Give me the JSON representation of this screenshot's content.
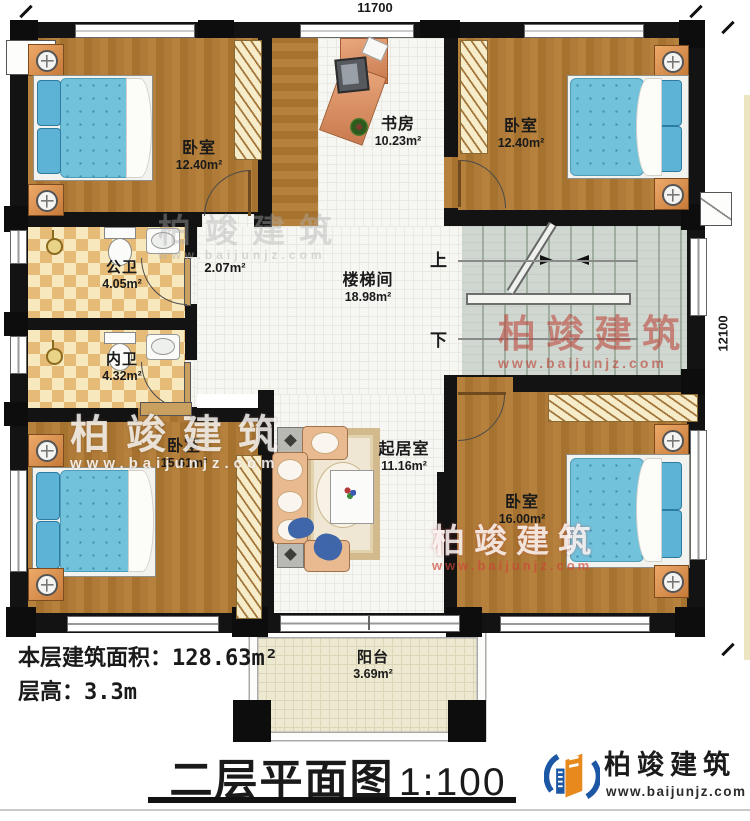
{
  "dimensions": {
    "top": "11700",
    "right": "12100"
  },
  "rooms": {
    "bedroom_tl": {
      "name": "卧室",
      "area": "12.40m²"
    },
    "study": {
      "name": "书房",
      "area": "10.23m²"
    },
    "bedroom_tr": {
      "name": "卧室",
      "area": "12.40m²"
    },
    "public_bath": {
      "name": "公卫",
      "area": "4.05m²"
    },
    "nook": {
      "area": "2.07m²"
    },
    "private_bath": {
      "name": "内卫",
      "area": "4.32m²"
    },
    "stair_hall": {
      "name": "楼梯间",
      "area": "18.98m²"
    },
    "bedroom_bl": {
      "name": "卧室",
      "area": "15.61m²"
    },
    "living": {
      "name": "起居室",
      "area": "11.16m²"
    },
    "bedroom_br": {
      "name": "卧室",
      "area": "16.00m²"
    },
    "balcony": {
      "name": "阳台",
      "area": "3.69m²"
    }
  },
  "stairs": {
    "up": "上",
    "down": "下"
  },
  "info": {
    "area_label": "本层建筑面积：",
    "area_value": "128.63m²",
    "height_label": "层高：",
    "height_value": "3.3m"
  },
  "footer": {
    "title": "二层平面图",
    "scale": "1:100"
  },
  "watermark": {
    "brand": "柏竣建筑",
    "url": "www.baijunjz.com"
  },
  "logo": {
    "brand": "柏竣建筑",
    "url": "www.baijunjz.com"
  },
  "colors": {
    "wall": "#131313",
    "wood": "#ad7a36",
    "tile": "#f6f6f3",
    "checker": "#e6bb77",
    "stair": "#cfd7d0",
    "balcony": "#ede8d0",
    "bed": "#72c2dc",
    "watermark_red": "#bc3a2e",
    "logo_blue": "#1c57a5",
    "logo_orange": "#e8891d"
  }
}
